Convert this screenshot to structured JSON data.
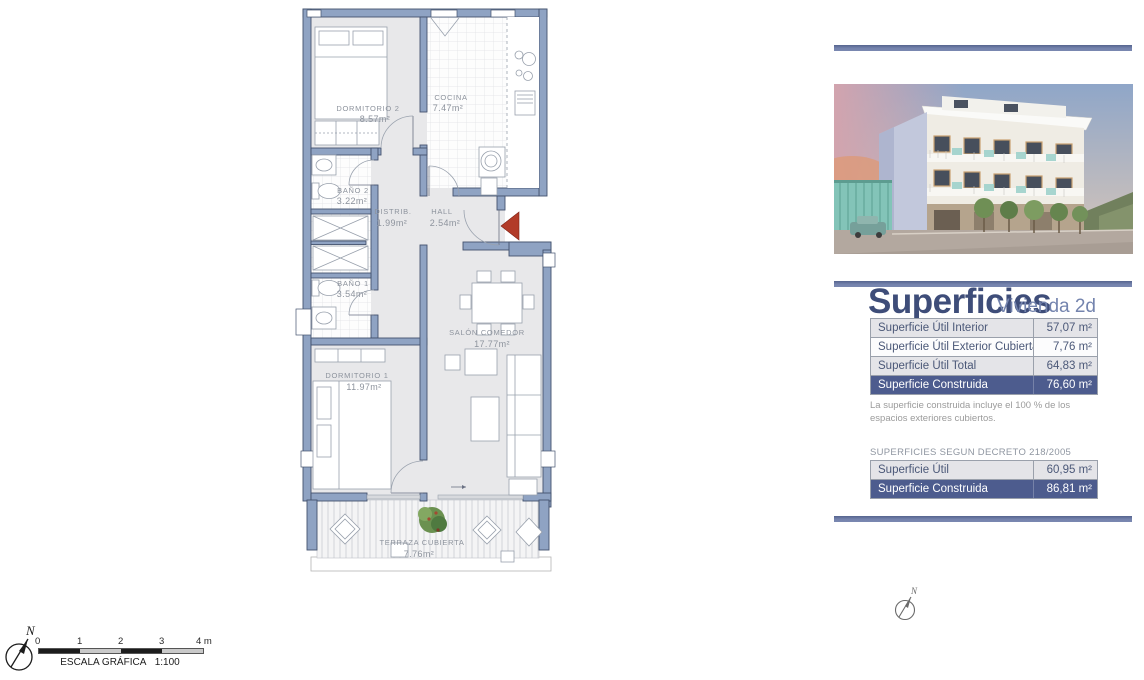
{
  "floorplan": {
    "rooms": [
      {
        "name": "DORMITORIO 2",
        "area": "8.57m²"
      },
      {
        "name": "COCINA",
        "area": "7.47m²"
      },
      {
        "name": "BAÑO 2",
        "area": "3.22m²"
      },
      {
        "name": "DISTRIB.",
        "area": "1.99m²"
      },
      {
        "name": "HALL",
        "area": "2.54m²"
      },
      {
        "name": "BAÑO 1",
        "area": "3.54m²"
      },
      {
        "name": "SALÓN COMEDOR",
        "area": "17.77m²"
      },
      {
        "name": "DORMITORIO 1",
        "area": "11.97m²"
      },
      {
        "name": "TERRAZA CUBIERTA",
        "area": "7.76m²"
      }
    ],
    "colors": {
      "wall": "#8fa3c3",
      "wall_stroke": "#44536e",
      "floor": "#e8e8ea",
      "entrance_arrow": "#b23b28"
    }
  },
  "scalebar": {
    "tick_labels": [
      "0",
      "1",
      "2",
      "3",
      "4 m"
    ],
    "caption": "ESCALA GRÁFICA",
    "ratio": "1:100"
  },
  "compass": {
    "label": "N"
  },
  "panel": {
    "accent_bar_color": "#7080aa",
    "title": "Superficies",
    "subtitle": "Vivienda 2d",
    "main_table": {
      "rows": [
        {
          "label": "Superficie Útil Interior",
          "value": "57,07 m²"
        },
        {
          "label": "Superficie Útil Exterior Cubierta",
          "value": "7,76 m²"
        },
        {
          "label": "Superficie Útil Total",
          "value": "64,83 m²"
        },
        {
          "label": "Superficie Construida",
          "value": "76,60 m²"
        }
      ]
    },
    "note": "La superficie construida incluye el 100 % de los espacios exteriores cubiertos.",
    "decree_title": "SUPERFICIES SEGUN DECRETO 218/2005",
    "decree_table": {
      "rows": [
        {
          "label": "Superficie Útil",
          "value": "60,95 m²"
        },
        {
          "label": "Superficie Construida",
          "value": "86,81 m²"
        }
      ]
    }
  }
}
